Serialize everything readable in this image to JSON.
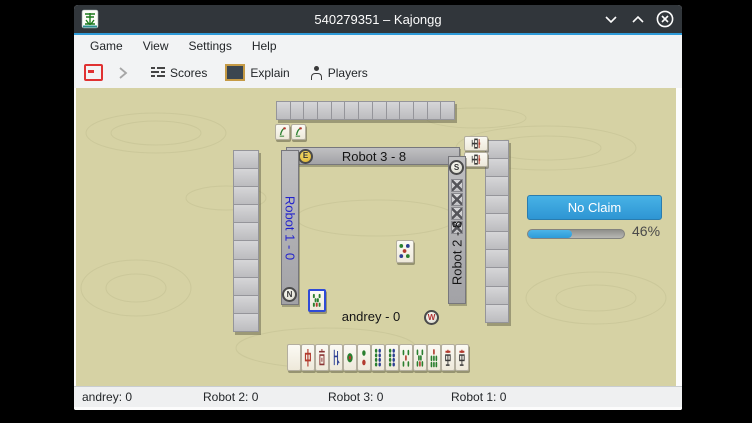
{
  "window": {
    "title": "540279351 – Kajongg"
  },
  "menubar": {
    "items": [
      "Game",
      "View",
      "Settings",
      "Help"
    ]
  },
  "toolbar": {
    "scores": "Scores",
    "explain": "Explain",
    "players": "Players"
  },
  "board": {
    "top_player": {
      "label": "Robot 3 - 8",
      "wind": "E"
    },
    "right_player": {
      "label": "Robot 2 - 8",
      "wind": "S",
      "concealed_tiles": 4,
      "exposed_tiles": [
        "character-9",
        "character-9"
      ]
    },
    "left_player": {
      "label": "Robot 1 - 0",
      "wind": "N"
    },
    "bottom_player": {
      "label": "andrey - 0",
      "wind": "W"
    },
    "top_exposed_tiles": [
      "bamboo-1",
      "bamboo-1"
    ],
    "discards": [
      {
        "kind": "circle-5",
        "focused": false
      },
      {
        "kind": "bamboo-8",
        "focused": true
      }
    ],
    "hand_tiles": [
      "blank",
      "dragon-red",
      "wind-south",
      "wind-north",
      "circle-1",
      "circle-2",
      "circle-8",
      "circle-8",
      "bamboo-5",
      "bamboo-8",
      "bamboo-7",
      "character-9",
      "character-9"
    ],
    "action_button": "No Claim",
    "progress": {
      "percent": 46,
      "label": "46%"
    },
    "walls": {
      "top": 13,
      "left": 10,
      "right": 10
    }
  },
  "statusbar": {
    "items": [
      "andrey: 0",
      "Robot 2: 0",
      "Robot 3: 0",
      "Robot 1: 0"
    ]
  },
  "colors": {
    "accent": "#2e9ad8",
    "button_blue": "#39a1dc",
    "board_bg": "#d6d2a4",
    "focus_blue": "#2f4bd6",
    "robot1_text": "#2323cc",
    "titlebar": "#31363b"
  }
}
